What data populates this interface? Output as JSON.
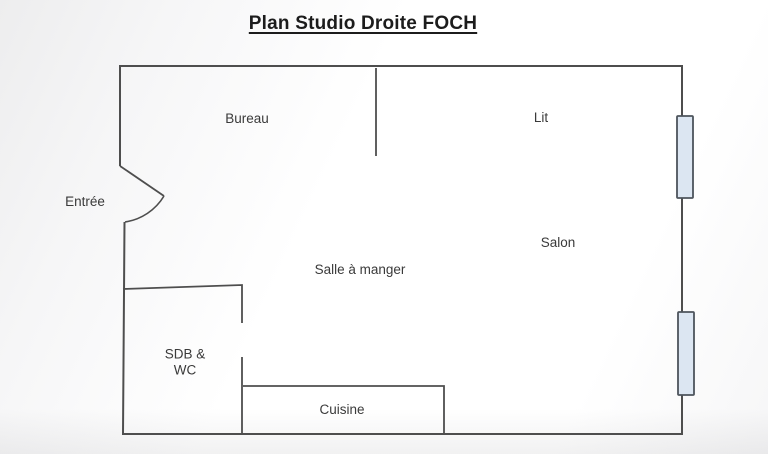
{
  "title": {
    "text": "Plan Studio Droite FOCH"
  },
  "plan": {
    "wall_color": "#4e4e4e",
    "window_fill": "#dce6f2",
    "window_border": "#4d545c",
    "rooms": [
      {
        "id": "entree",
        "label": "Entrée"
      },
      {
        "id": "bureau",
        "label": "Bureau"
      },
      {
        "id": "lit",
        "label": "Lit"
      },
      {
        "id": "salon",
        "label": "Salon"
      },
      {
        "id": "salle-a-manger",
        "label": "Salle à manger"
      },
      {
        "id": "sdb-wc",
        "label": "SDB &\nWC"
      },
      {
        "id": "cuisine",
        "label": "Cuisine"
      }
    ]
  }
}
